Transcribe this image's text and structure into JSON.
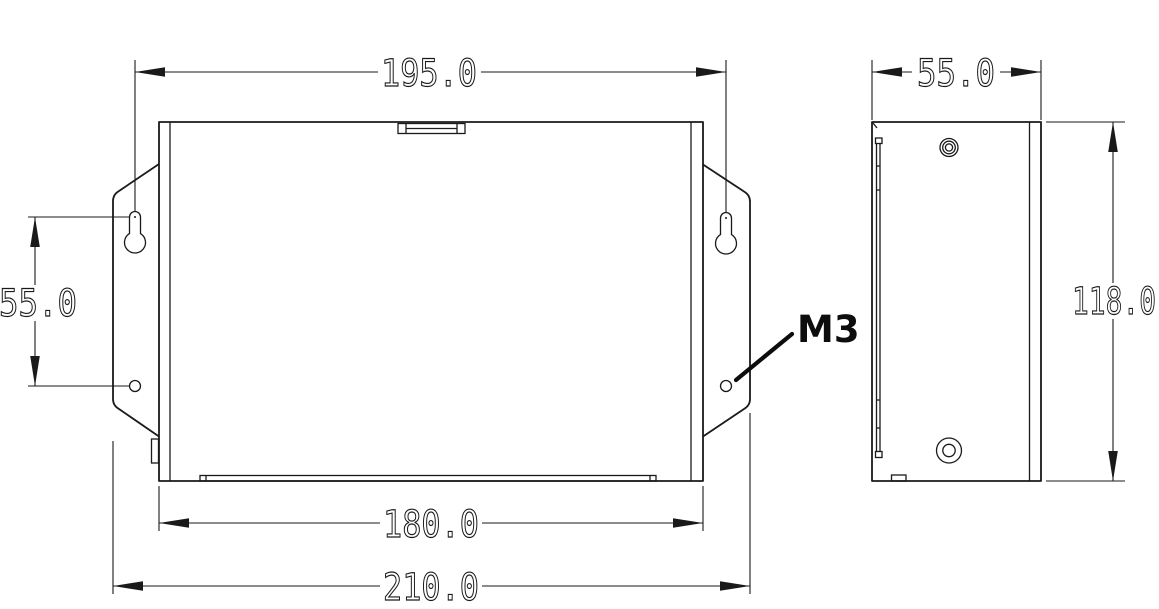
{
  "page": {
    "background_color": "#ffffff",
    "line_color": "#1a1a1a",
    "description": "Two-view dimensioned mechanical drawing of a wall-mount enclosure"
  },
  "front_view": {
    "dims": {
      "mount_hole_span": "195.0",
      "mount_hole_vertical_spacing": "55.0",
      "body_width": "180.0",
      "overall_width": "210.0"
    },
    "labels": {
      "thread_callout": "M3"
    }
  },
  "side_view": {
    "dims": {
      "depth": "55.0",
      "height": "118.0"
    }
  }
}
